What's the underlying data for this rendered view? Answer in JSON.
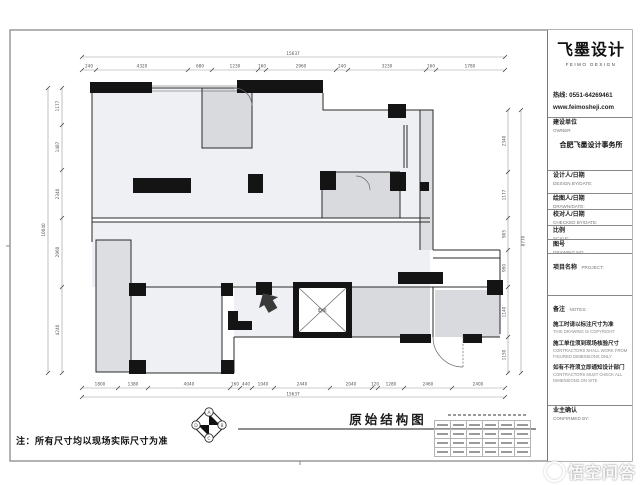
{
  "title_block": {
    "logo": {
      "title": "飞墨设计",
      "subtitle": "FEIMO DESIGN"
    },
    "hotline": "热线: 0551-64269461",
    "website": "www.feimosheji.com",
    "owner": {
      "label_cn": "建设单位",
      "label_en": "OWNER",
      "value": "合肥飞墨设计事务所"
    },
    "rows": [
      {
        "cn": "设计人/日期",
        "en": "DESIGN BY/DATE:"
      },
      {
        "cn": "绘图人/日期",
        "en": "DRAWN/DATE:"
      },
      {
        "cn": "校对人/日期",
        "en": "CHECKED BY/DATE:"
      },
      {
        "cn": "比例",
        "en": "SCALE:"
      },
      {
        "cn": "图号",
        "en": "DRAWING NO:"
      },
      {
        "cn": "项目名称",
        "en": "PROJECT:"
      }
    ],
    "notes": {
      "label_cn": "备注",
      "label_en": "NOTES:",
      "items": [
        {
          "cn": "施工时请以标注尺寸为准",
          "en": "THIS DRAWING IS COPYRIGHT"
        },
        {
          "cn": "施工单位须到现场核验尺寸",
          "en": "CONTRACTORS SHALL WORK FROM FIGURED DIMENSIONS ONLY"
        },
        {
          "cn": "如有不符须立即通知设计部门",
          "en": "CONTRACTORS MUST CHECK ALL DIMENSIONS ON SITE"
        }
      ]
    },
    "confirm": {
      "cn": "业主确认",
      "en": "CONFIRMED BY:"
    }
  },
  "figure": {
    "title": "原始结构图",
    "note": "注：所有尺寸均以现场实际尺寸为准",
    "elevator_label": "电梯",
    "compass": [
      "A",
      "B",
      "C",
      "D"
    ]
  },
  "plan": {
    "dims": {
      "top_overall": "15637",
      "top": [
        "240",
        "4320",
        "680",
        "1230",
        "160",
        "2960",
        "240",
        "3230",
        "160",
        "1780"
      ],
      "bottom": [
        "1800",
        "1380",
        "4040",
        "160",
        "440",
        "1040",
        "2440",
        "2040",
        "120",
        "1280",
        "2460",
        "2400"
      ],
      "bottom_overall": "15637",
      "left": [
        "1177",
        "1487",
        "2340",
        "2960",
        "4240"
      ],
      "left_overall": "10040",
      "right": [
        "2340",
        "1177",
        "905",
        "960",
        "1140",
        "1150"
      ],
      "right_overall": "8770"
    }
  },
  "watermark": {
    "text": "悟空问答"
  },
  "colors": {
    "wall": "#141414",
    "room_light": "#eef0f4",
    "room_gray": "#d8dade",
    "frame": "#8a8a8a"
  }
}
